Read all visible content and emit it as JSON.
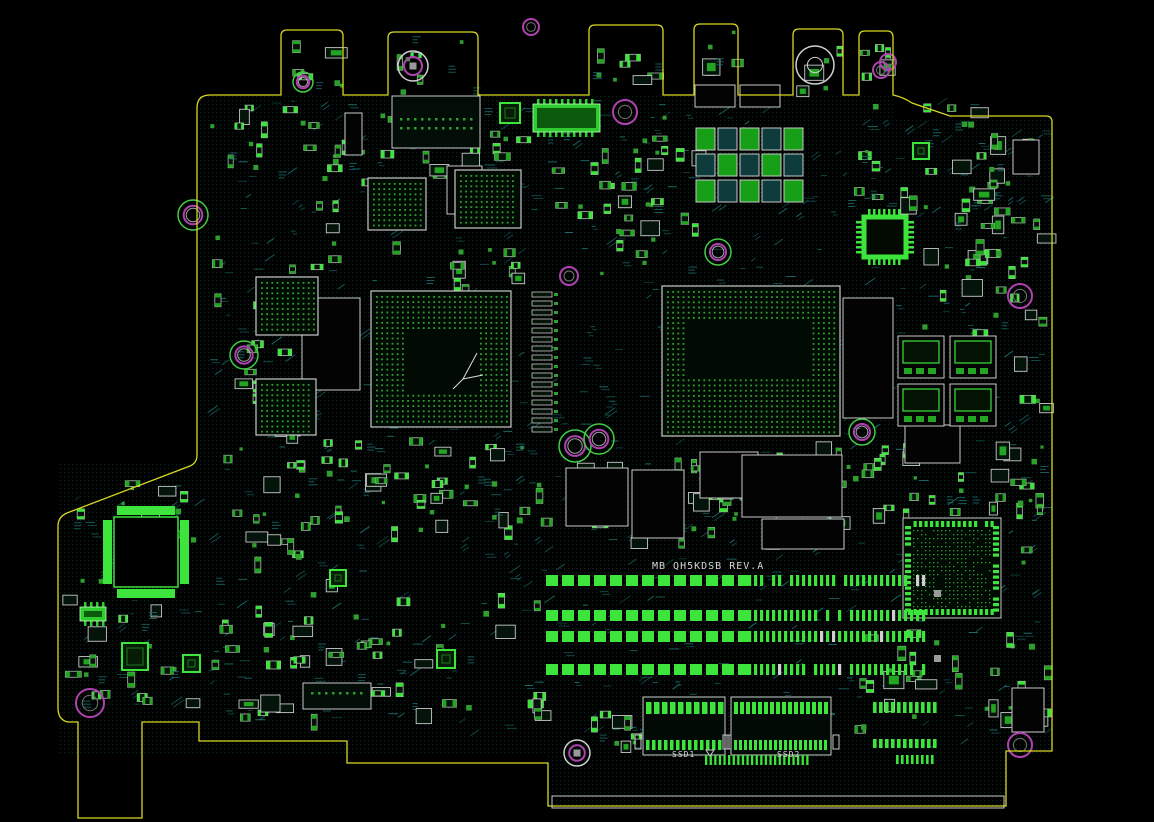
{
  "app": {
    "title": "PCB board layout view"
  },
  "texts": {
    "board_label": "MB QH5KDSB REV.A",
    "ssd1_label": "SSD1",
    "ssd2_label": "SSD2"
  },
  "colors": {
    "background": "#000000",
    "board_edge": "#d8d822",
    "silkscreen": "#c9c9c9",
    "text": "#d6d6d6",
    "pad_bright": "#3ce43c",
    "pad_mid": "#23a523",
    "bga_dot": "#2f9e2f",
    "hatch": "#1e6f6f",
    "hole_magenta": "#b042b0",
    "hole_green": "#45cc45",
    "copper_dot": "#0b4433",
    "dark_fill": "#041208"
  },
  "board": {
    "outline_path": "M 197,108 Q 197,95 210,95 H 281 V 36 Q 281,30 287,30 H 337 Q 343,30 343,36 V 95 H 388 V 38 Q 388,32 394,32 H 472 Q 478,32 478,38 V 95 H 589 V 31 Q 589,25 595,25 H 657 Q 663,25 663,31 V 95 H 694 V 30 Q 694,24 700,24 H 732 Q 738,24 738,30 V 95 H 793 V 35 Q 793,29 799,29 H 837 Q 843,29 843,35 V 95 H 859 V 37 Q 859,31 865,31 H 887 Q 893,31 893,37 V 95 Q 903,97 912,103 L 950,116 H 1046 Q 1052,116 1052,122 V 751 H 1006 V 806 H 548 V 763 H 347 V 741 H 199 V 722 H 142 V 818 H 78 V 722 H 68 Q 58,720 58,708 V 526 Q 58,517 67,513 L 190,466 Q 197,463 197,455 Z",
    "texture_seed": 7,
    "hatch_count": 640,
    "pattern_rects": [
      [
        197,
        95,
        696,
        24
      ],
      [
        197,
        118,
        855,
        636
      ],
      [
        57,
        462,
        140,
        292
      ],
      [
        548,
        755,
        458,
        50
      ]
    ]
  },
  "holes": [
    [
      413,
      66,
      15,
      "wm"
    ],
    [
      531,
      27,
      8,
      "m"
    ],
    [
      625,
      112,
      12,
      "m"
    ],
    [
      718,
      252,
      13,
      "gm"
    ],
    [
      881,
      70,
      8,
      "m"
    ],
    [
      1020,
      296,
      12,
      "m"
    ],
    [
      862,
      432,
      13,
      "gm"
    ],
    [
      575,
      446,
      16,
      "gm"
    ],
    [
      599,
      439,
      15,
      "gm"
    ],
    [
      193,
      215,
      15,
      "gm"
    ],
    [
      244,
      355,
      14,
      "gm"
    ],
    [
      303,
      82,
      10,
      "gm"
    ],
    [
      90,
      703,
      14,
      "m"
    ],
    [
      577,
      753,
      13,
      "wm"
    ],
    [
      1020,
      745,
      12,
      "m"
    ],
    [
      569,
      276,
      9,
      "m"
    ],
    [
      815,
      65,
      19,
      "w"
    ],
    [
      888,
      62,
      8,
      "m"
    ]
  ],
  "bgas": [
    {
      "name": "cpu-bga",
      "x": 662,
      "y": 286,
      "w": 178,
      "h": 150,
      "hollow": [
        684,
        318,
        124,
        58
      ],
      "arrow": false
    },
    {
      "name": "gpu-bga",
      "x": 371,
      "y": 291,
      "w": 140,
      "h": 136,
      "hollow": [
        407,
        330,
        68,
        60
      ],
      "arrow": true
    },
    {
      "name": "bga-left-1",
      "x": 256,
      "y": 277,
      "w": 62,
      "h": 58,
      "hollow": null,
      "arrow": false
    },
    {
      "name": "bga-left-2",
      "x": 256,
      "y": 379,
      "w": 60,
      "h": 56,
      "hollow": null,
      "arrow": false
    },
    {
      "name": "bga-top-1",
      "x": 368,
      "y": 178,
      "w": 58,
      "h": 52,
      "hollow": null,
      "arrow": false
    },
    {
      "name": "bga-top-2",
      "x": 455,
      "y": 170,
      "w": 66,
      "h": 58,
      "hollow": null,
      "arrow": false
    }
  ],
  "bga_dense": {
    "name": "bga-bottom-right",
    "x": 903,
    "y": 518,
    "w": 98,
    "h": 100
  },
  "qfps": [
    {
      "name": "ec-qfp",
      "x": 110,
      "y": 513,
      "w": 72,
      "h": 78,
      "style": "bars"
    },
    {
      "name": "io-qfp",
      "x": 862,
      "y": 215,
      "w": 46,
      "h": 44,
      "style": "comb"
    }
  ],
  "qfns": [
    [
      500,
      103,
      20,
      20
    ],
    [
      913,
      143,
      16,
      16
    ],
    [
      122,
      643,
      26,
      27
    ],
    [
      183,
      655,
      17,
      17
    ],
    [
      437,
      650,
      18,
      18
    ],
    [
      330,
      570,
      16,
      16
    ]
  ],
  "soics": [
    [
      533,
      104,
      67,
      28
    ],
    [
      80,
      607,
      26,
      14
    ]
  ],
  "ram_rows": {
    "ys": [
      575,
      610,
      631,
      664
    ],
    "x": 546,
    "left_end": 742,
    "right_start": 748,
    "right_end": 928,
    "h": 11,
    "seed": 31
  },
  "ssd_connectors": [
    {
      "name": "ssd1-connector",
      "x": 643,
      "y": 697,
      "w": 82,
      "p1": 8,
      "w1": 5.5,
      "p2": 6,
      "w2": 3.5
    },
    {
      "name": "ssd2-connector",
      "x": 731,
      "y": 697,
      "w": 100,
      "p1": 6,
      "w1": 4,
      "p2": 5,
      "w2": 3
    }
  ],
  "conn_rows": [
    [
      873,
      702,
      66,
      6,
      3.6,
      11
    ],
    [
      873,
      739,
      66,
      6,
      3.6,
      9
    ],
    [
      896,
      755,
      40,
      5,
      2.6,
      9
    ],
    [
      705,
      755,
      104,
      4.6,
      2.3,
      10
    ]
  ],
  "dot_connectors": [
    [
      392,
      96,
      88,
      52,
      2
    ],
    [
      303,
      683,
      68,
      26,
      1
    ]
  ],
  "white_boxes": [
    [
      695,
      85,
      40,
      22
    ],
    [
      740,
      85,
      40,
      22
    ],
    [
      447,
      166,
      35,
      48
    ],
    [
      345,
      113,
      17,
      42
    ],
    [
      1012,
      688,
      32,
      44
    ],
    [
      1013,
      140,
      26,
      34
    ]
  ],
  "dark_boxes": [
    [
      566,
      468,
      62,
      58
    ],
    [
      632,
      470,
      52,
      68
    ],
    [
      700,
      452,
      58,
      46
    ],
    [
      742,
      455,
      100,
      62
    ],
    [
      762,
      519,
      82,
      30
    ],
    [
      302,
      298,
      58,
      92
    ],
    [
      843,
      298,
      50,
      120
    ],
    [
      905,
      425,
      55,
      38
    ]
  ],
  "pin_column": {
    "x": 532,
    "y": 292,
    "to": 428,
    "step": 9
  },
  "cap_bank": {
    "x": 696,
    "y": 128,
    "cols": 5,
    "rows": 3,
    "cw": 22,
    "ch": 26
  },
  "mosfet_bank": {
    "cells": [
      [
        898,
        336
      ],
      [
        950,
        336
      ],
      [
        898,
        384
      ],
      [
        950,
        384
      ]
    ],
    "w": 46,
    "h": 42
  },
  "ram_end_squares": [
    [
      934,
      590,
      7,
      7
    ],
    [
      934,
      655,
      7,
      7
    ]
  ],
  "label_pos": {
    "board": [
      652,
      569
    ],
    "ssd1": [
      672,
      757
    ],
    "ssd2": [
      777,
      757
    ]
  },
  "clusters": [
    [
      210,
      100,
      320,
      85,
      42,
      1
    ],
    [
      205,
      195,
      145,
      245,
      34,
      2
    ],
    [
      330,
      432,
      215,
      100,
      46,
      3
    ],
    [
      212,
      445,
      115,
      140,
      26,
      4
    ],
    [
      548,
      98,
      120,
      115,
      22,
      5
    ],
    [
      600,
      145,
      95,
      130,
      20,
      6
    ],
    [
      848,
      98,
      150,
      108,
      28,
      7
    ],
    [
      915,
      205,
      125,
      125,
      24,
      8
    ],
    [
      852,
      440,
      190,
      72,
      30,
      9
    ],
    [
      62,
      472,
      132,
      240,
      40,
      10
    ],
    [
      212,
      592,
      325,
      125,
      56,
      11
    ],
    [
      548,
      458,
      300,
      88,
      36,
      12
    ],
    [
      852,
      625,
      185,
      115,
      26,
      13
    ],
    [
      588,
      688,
      55,
      55,
      10,
      14
    ],
    [
      948,
      122,
      95,
      80,
      16,
      15
    ],
    [
      1008,
      210,
      38,
      520,
      22,
      16
    ],
    [
      286,
      36,
      54,
      52,
      8,
      17
    ],
    [
      392,
      36,
      84,
      56,
      10,
      18
    ],
    [
      592,
      32,
      66,
      56,
      9,
      19
    ],
    [
      696,
      30,
      38,
      58,
      6,
      20
    ],
    [
      795,
      36,
      44,
      52,
      6,
      21
    ],
    [
      860,
      40,
      28,
      48,
      5,
      22
    ],
    [
      370,
      240,
      150,
      45,
      14,
      23
    ],
    [
      680,
      440,
      170,
      60,
      24,
      24
    ]
  ]
}
